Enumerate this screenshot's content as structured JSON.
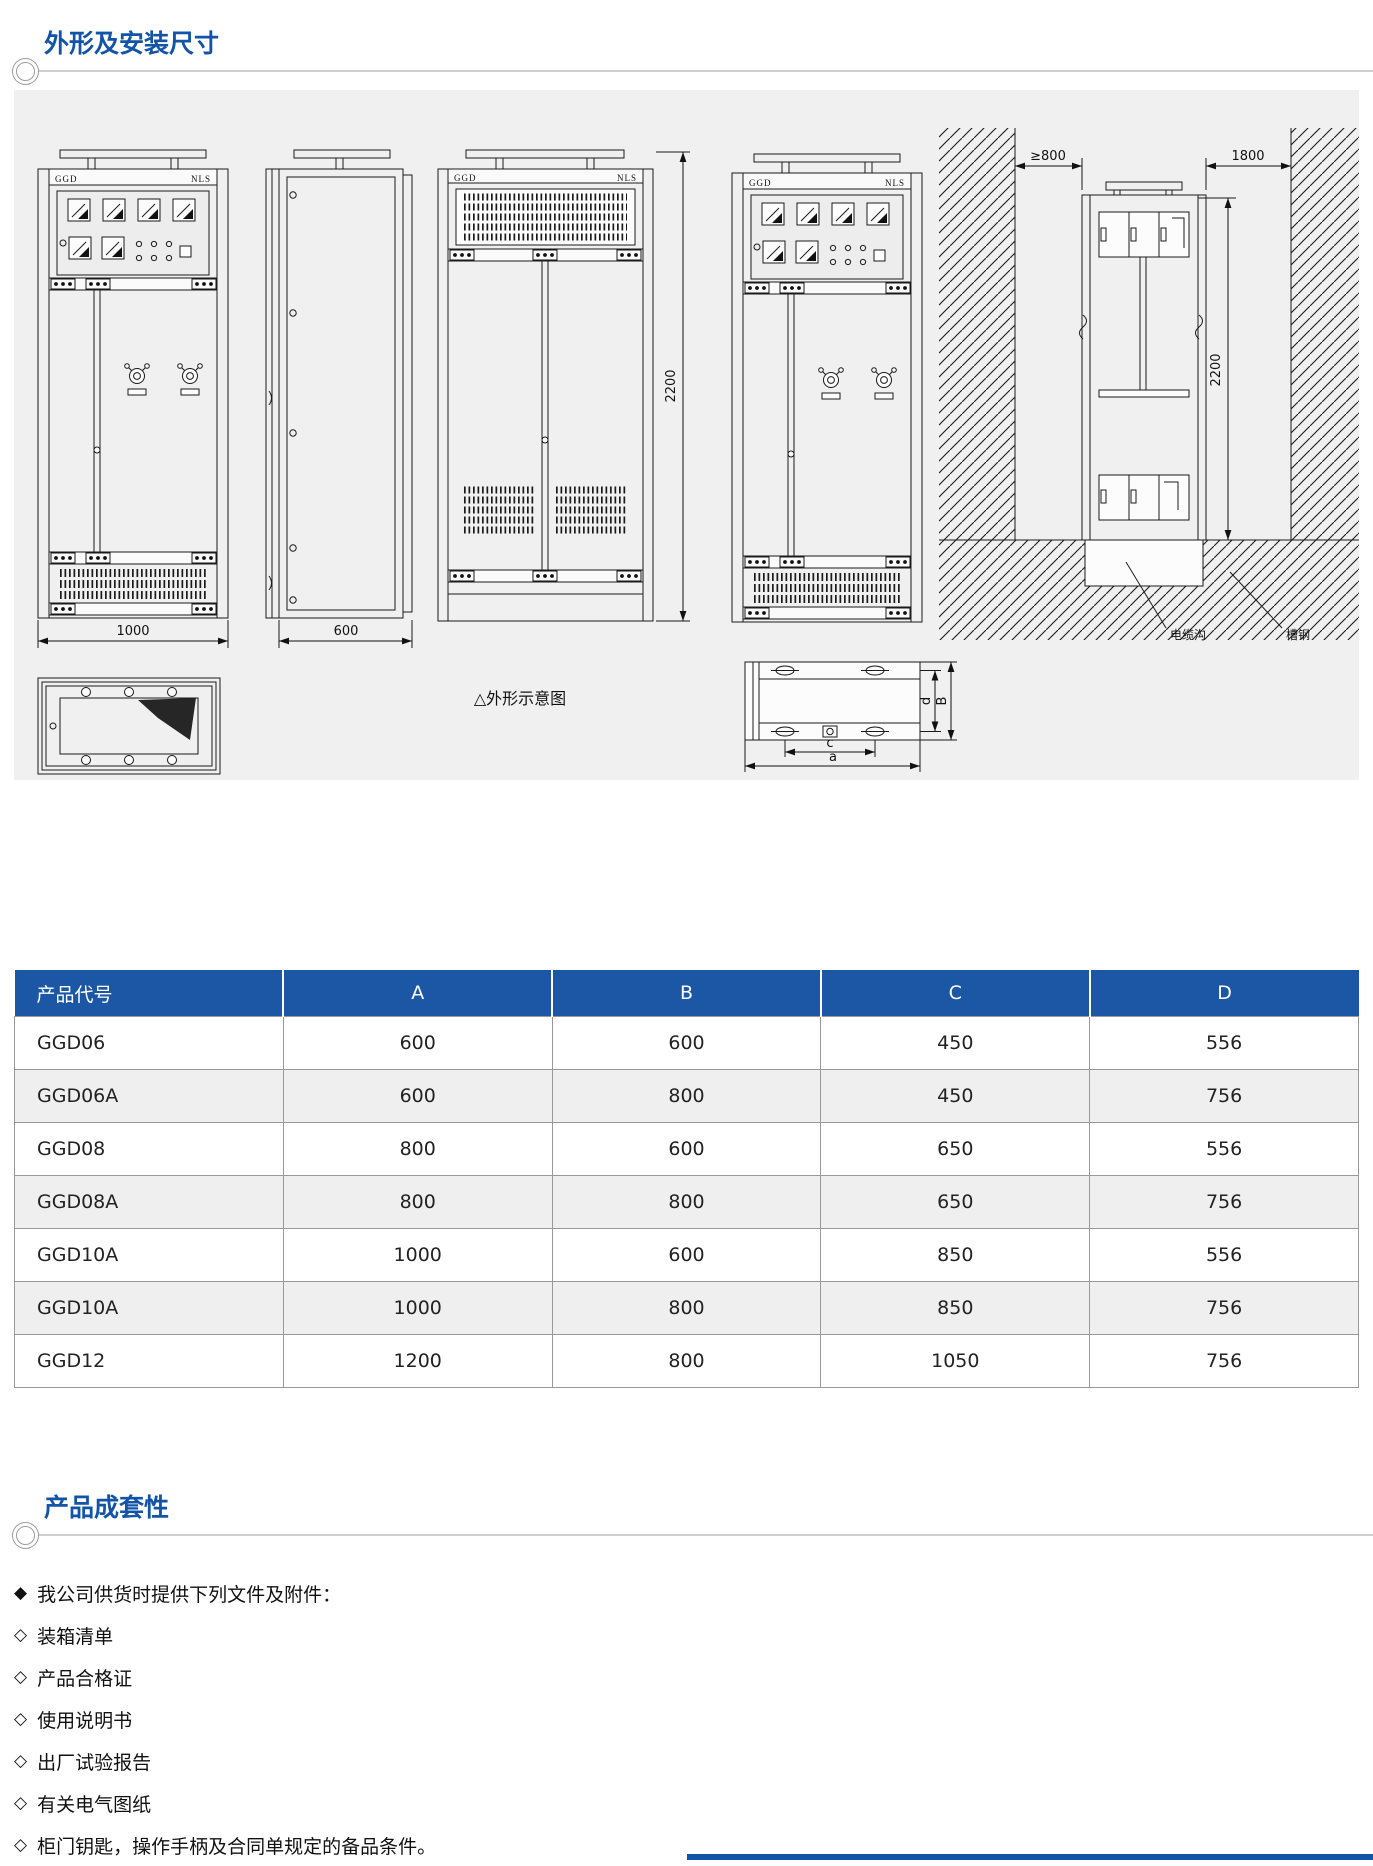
{
  "sections": {
    "dimensions_title": "外形及安装尺寸",
    "completeness_title": "产品成套性"
  },
  "diagram": {
    "caption": "△外形示意图",
    "cabinet_brand_left": "GGD",
    "cabinet_brand_right": "NLS",
    "dims": {
      "front_width": "1000",
      "side_depth": "600",
      "cabinet_height": "2200",
      "wall_clearance": "≥800",
      "rear_aisle": "1800",
      "install_height": "2200",
      "base_width": "a",
      "base_depth": "B",
      "base_bolt_span": "c",
      "base_bolt_depth": "d"
    },
    "callouts": {
      "cable_trench": "电缆沟",
      "channel_steel": "槽钢"
    }
  },
  "table": {
    "headers": [
      "产品代号",
      "A",
      "B",
      "C",
      "D"
    ],
    "rows": [
      [
        "GGD06",
        "600",
        "600",
        "450",
        "556"
      ],
      [
        "GGD06A",
        "600",
        "800",
        "450",
        "756"
      ],
      [
        "GGD08",
        "800",
        "600",
        "650",
        "556"
      ],
      [
        "GGD08A",
        "800",
        "800",
        "650",
        "756"
      ],
      [
        "GGD10A",
        "1000",
        "600",
        "850",
        "556"
      ],
      [
        "GGD10A",
        "1000",
        "800",
        "850",
        "756"
      ],
      [
        "GGD12",
        "1200",
        "800",
        "1050",
        "756"
      ]
    ]
  },
  "completeness": {
    "intro_bullet": "◆",
    "intro": "我公司供货时提供下列文件及附件：",
    "item_bullet": "◇",
    "items": [
      "装箱清单",
      "产品合格证",
      "使用说明书",
      "出厂试验报告",
      "有关电气图纸",
      "柜门钥匙，操作手柄及合同单规定的备品条件。"
    ]
  },
  "colors": {
    "accent": "#1254a8",
    "table_header_bg": "#1b57a5",
    "row_alt": "#efefef",
    "panel_bg": "#f0f0f0",
    "line": "#1a1a1a"
  }
}
